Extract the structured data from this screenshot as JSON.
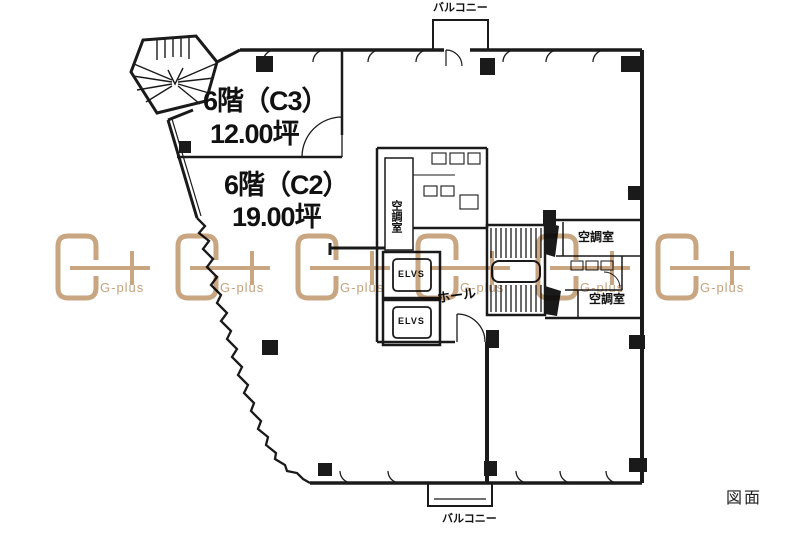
{
  "page": {
    "background": "#ffffff",
    "drawing_label": "図面"
  },
  "floor_plan": {
    "floor": "6階",
    "units": [
      {
        "label": "6階（C3）",
        "area": "12.00坪"
      },
      {
        "label": "6階（C2）",
        "area": "19.00坪"
      }
    ],
    "rooms": {
      "balcony_top": "バルコニー",
      "balcony_bottom": "バルコニー",
      "hvac_left": "空調室",
      "hvac_right_top": "空調室",
      "hvac_right_bottom": "空調室",
      "elevator_1": "ELVS",
      "elevator_2": "ELVS",
      "hall": "ホール"
    },
    "line_color": "#1a1a1a"
  },
  "watermark": {
    "label": "G-plus",
    "color": "#c5a17b",
    "count": 6
  }
}
